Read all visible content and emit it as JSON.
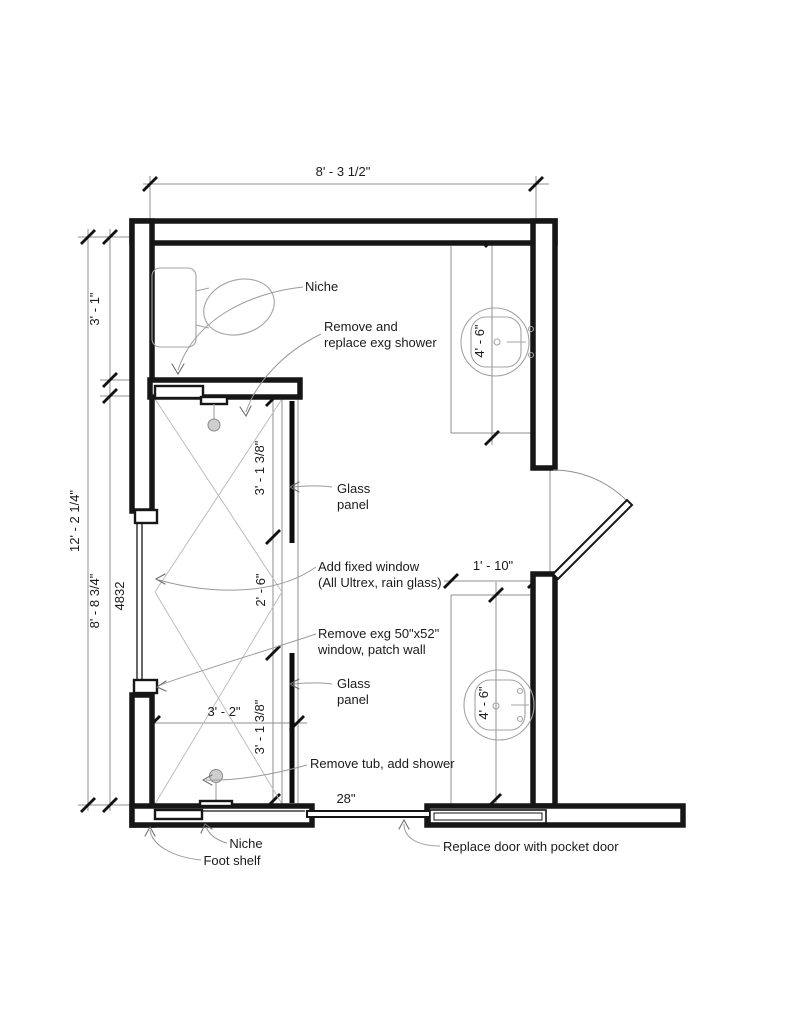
{
  "drawing": {
    "colors": {
      "background": "#ffffff",
      "wall_line": "#161616",
      "thin_line": "#8f8f8f",
      "fixture_line": "#a3a3a3",
      "hatch_line": "#bdbdbd",
      "text": "#1b1b1b",
      "glass_line": "#0d0d0d"
    },
    "dims": {
      "top_width": "8' - 3 1/2\"",
      "left_total": "12' - 2 1/4\"",
      "left_upper": "3' - 1\"",
      "left_lower": "8' - 8 3/4\"",
      "window_size": "4832",
      "glass_panel_upper": "3' - 1 3/8\"",
      "shower_opening": "2' - 6\"",
      "glass_panel_lower": "3' - 1 3/8\"",
      "shower_width": "3' - 2\"",
      "vanity_upper": "4' - 6\"",
      "vanity_lower": "4' - 6\"",
      "counter_depth": "1' - 10\"",
      "door_width": "28\""
    },
    "annotations": {
      "niche_top": "Niche",
      "shower_line1": "Remove and",
      "shower_line2": "replace exg shower",
      "glass_upper_line1": "Glass",
      "glass_upper_line2": "panel",
      "window_add_line1": "Add fixed window",
      "window_add_line2": "(All Ultrex, rain glass)",
      "window_remove_line1": "Remove exg 50\"x52\"",
      "window_remove_line2": "window, patch wall",
      "glass_lower_line1": "Glass",
      "glass_lower_line2": "panel",
      "tub": "Remove tub, add shower",
      "pocket_door": "Replace door with pocket door",
      "niche_bottom": "Niche",
      "foot_shelf": "Foot shelf"
    }
  }
}
